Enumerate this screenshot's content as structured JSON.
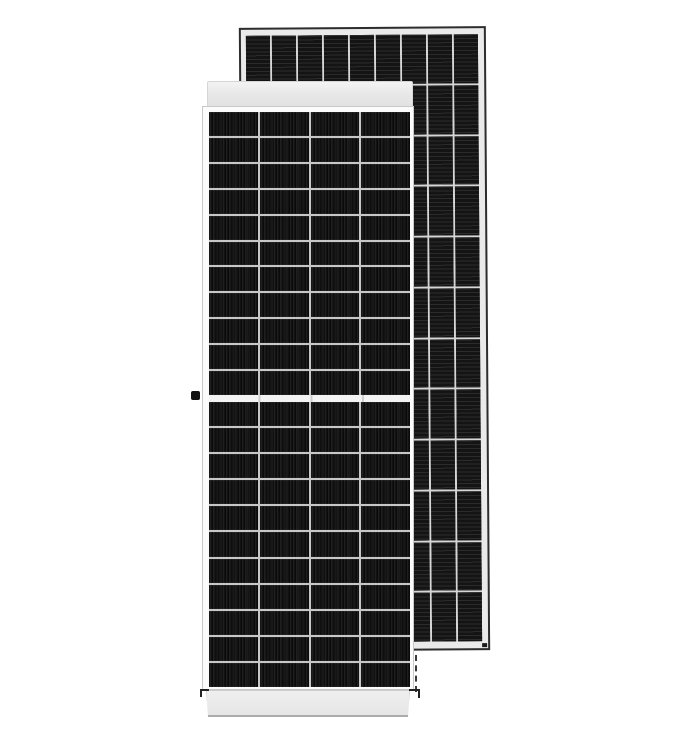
{
  "image": {
    "type": "product-photo",
    "subject": "Two framed monocrystalline half-cut solar panel modules standing upright on a plain white background; front module shown face-on, second module behind it slightly tilted showing its back side",
    "background_color": "#ffffff"
  },
  "colors": {
    "background": "#ffffff",
    "frame_light": "#eaeaea",
    "frame_outline_dark": "#2d2d2d",
    "face_white": "#fbfbfb",
    "face_outline": "#c9c9c9",
    "grid_separator": "#c7c7c7",
    "back_grid_separator": "#d6d6d6",
    "front_stripe_light": "#1f1f1f",
    "back_stripe_light": "#2b2b2b",
    "knob_black": "#101010"
  },
  "front_panel": {
    "label": "front solar panel module, front view, half-cell layout with central gap",
    "columns": 4,
    "rows_upper": 11,
    "rows_lower": 11,
    "has_center_gap": true,
    "cell_texture": "fine vertical busbar stripes",
    "frame_parts": [
      "top frame band",
      "glass face with cell grid",
      "bottom frame band",
      "left-side mounting knob",
      "dashed side frame edge",
      "corner brackets"
    ]
  },
  "back_panel": {
    "label": "rear solar panel module, back view, slightly tilted",
    "columns": 9,
    "rows": 12,
    "rotation_deg": -0.4,
    "cell_texture": "horizontal ribbon stripes",
    "frame_parts": [
      "light aluminium frame",
      "corner screw mark"
    ]
  }
}
